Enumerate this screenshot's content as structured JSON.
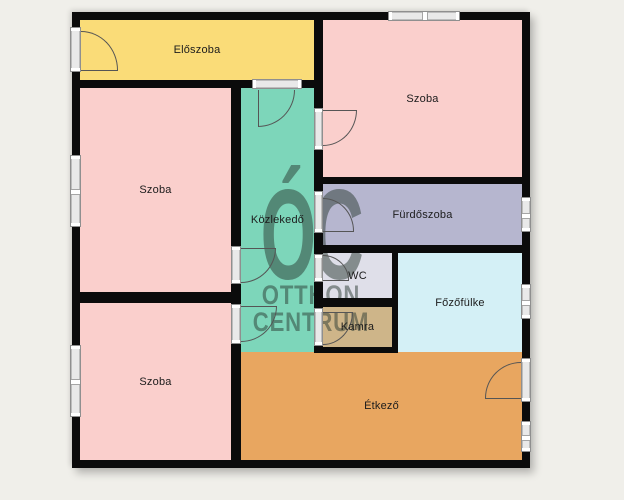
{
  "title": "Floor plan",
  "watermark": {
    "monogram": "ÓC",
    "line1": "OTTHON",
    "line2": "CENTRUM"
  },
  "rooms": [
    {
      "id": "eloszoba",
      "label": "Előszoba",
      "color": "#fadc78"
    },
    {
      "id": "szoba-top-right",
      "label": "Szoba",
      "color": "#facfcc"
    },
    {
      "id": "szoba-middle-left",
      "label": "Szoba",
      "color": "#facfcc"
    },
    {
      "id": "kozlekedo",
      "label": "Közlekedő",
      "color": "#7dd6ba"
    },
    {
      "id": "furdoszoba",
      "label": "Fürdőszoba",
      "color": "#b6b6cf"
    },
    {
      "id": "wc",
      "label": "WC",
      "color": "#dfdfe9"
    },
    {
      "id": "fozofulke",
      "label": "Főzőfülke",
      "color": "#d4f0f6"
    },
    {
      "id": "kamra",
      "label": "Kamra",
      "color": "#ceb589"
    },
    {
      "id": "szoba-bottom-left",
      "label": "Szoba",
      "color": "#facfcc"
    },
    {
      "id": "etkezo",
      "label": "Étkező",
      "color": "#e8a660"
    }
  ],
  "palette": {
    "background": "#f0efea",
    "wall": "#0b0b0b",
    "window_frame": "#8f8f8f",
    "door_arc": "#555555",
    "watermark": "rgba(42,58,50,0.5)",
    "label_text": "#1c1c1c"
  }
}
